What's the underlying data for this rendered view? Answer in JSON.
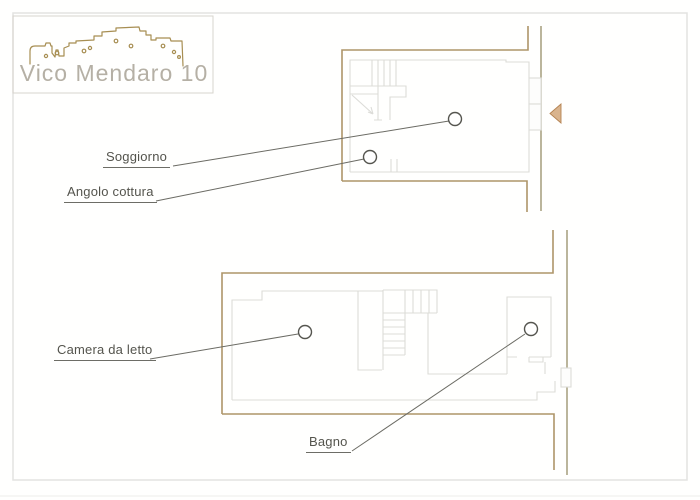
{
  "logo": {
    "title": "Vico Mendaro 10"
  },
  "floor_plans": {
    "upper": {
      "name": "Upper floor plan",
      "labels": [
        {
          "id": "soggiorno",
          "text": "Soggiorno"
        },
        {
          "id": "angolo-cottura",
          "text": "Angolo cottura"
        }
      ]
    },
    "lower": {
      "name": "Lower floor plan",
      "labels": [
        {
          "id": "camera-da-letto",
          "text": "Camera da letto"
        },
        {
          "id": "bagno",
          "text": "Bagno"
        }
      ]
    }
  },
  "colors": {
    "background": "#fffffe",
    "frame_border": "#e3e3e1",
    "logo_border": "#d7d4cd",
    "skyline": "#a78e52",
    "logo_text": "#b5b0a5",
    "wall": "#ae9569",
    "wall_olive": "#9e9673",
    "interior": "#dcdcd8",
    "leader": "#6b6b64",
    "marker_stroke": "#55554f",
    "label_text": "#54544d",
    "underline": "#6d6d66",
    "door_marker_fill": "#d9b48e",
    "door_marker_edge": "#b58352"
  }
}
